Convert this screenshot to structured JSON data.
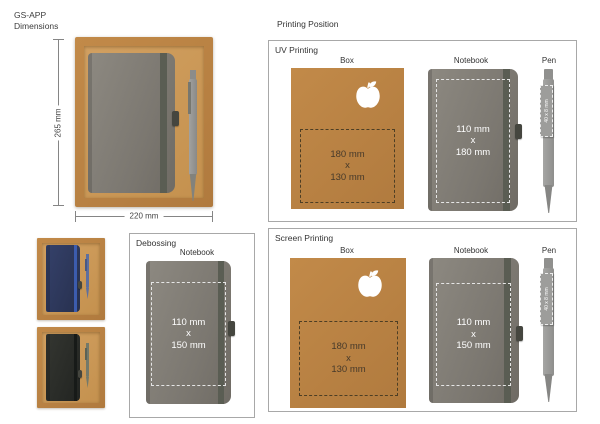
{
  "header": {
    "product_code": "GS-APP",
    "subtitle": "Dimensions"
  },
  "dimensions": {
    "height": "265 mm",
    "width": "220 mm"
  },
  "printing": {
    "title": "Printing Position",
    "uv": {
      "title": "UV Printing",
      "box": {
        "label": "Box",
        "lines": [
          "180 mm",
          "x",
          "130 mm"
        ]
      },
      "notebook": {
        "label": "Notebook",
        "lines": [
          "110 mm",
          "x",
          "180 mm"
        ]
      },
      "pen": {
        "label": "Pen",
        "print_area": "40 x 8 mm"
      }
    },
    "screen": {
      "title": "Screen Printing",
      "box": {
        "label": "Box",
        "lines": [
          "180 mm",
          "x",
          "130 mm"
        ]
      },
      "notebook": {
        "label": "Notebook",
        "lines": [
          "110 mm",
          "x",
          "150 mm"
        ]
      },
      "pen": {
        "label": "Pen",
        "print_area": "40 x 8 mm"
      }
    },
    "debossing": {
      "title": "Debossing",
      "notebook": {
        "label": "Notebook",
        "lines": [
          "110 mm",
          "x",
          "150 mm"
        ]
      }
    }
  },
  "icons": {
    "box_print_logo": "apple-icon"
  },
  "colors": {
    "kraft": "#c28a49",
    "kraft_tray": "#d2a061",
    "notebook_gray": "#7d7a73",
    "notebook_navy": "#2e3a5f",
    "notebook_black": "#2b2d2b",
    "pen_gray": "#96968f",
    "dashed_dark": "#4d3e24",
    "dashed_light": "#e6e6e6"
  }
}
